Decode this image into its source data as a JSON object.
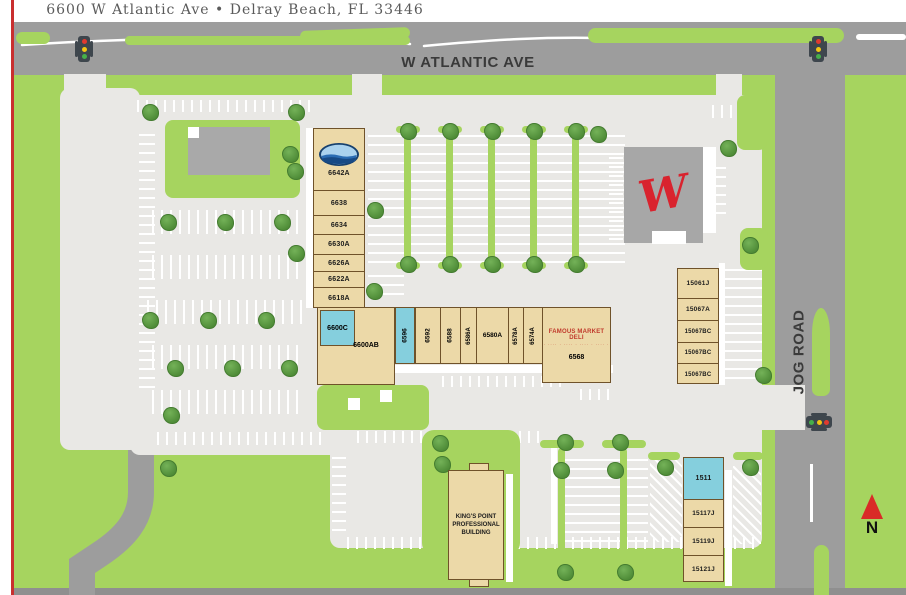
{
  "header": {
    "address": "6600 W Atlantic Ave • Delray Beach, FL 33446"
  },
  "roads": {
    "atlantic_label": "W ATLANTIC AVE",
    "jog_label": "JOG ROAD"
  },
  "compass": {
    "north_label": "N"
  },
  "colors": {
    "grass": "#a6d45f",
    "road": "#9d9d9d",
    "parking": "#e9e8e5",
    "building_tan": "#ecd9a8",
    "highlight_unit": "#85cfdd",
    "walgreens_red": "#d9232e",
    "deli_red": "#c0392b",
    "boundary_line": "#c92f2f"
  },
  "buildings": {
    "north_strip": {
      "units": [
        {
          "label": "6642A"
        },
        {
          "label": "6638"
        },
        {
          "label": "6634"
        },
        {
          "label": "6630A"
        },
        {
          "label": "6626A"
        },
        {
          "label": "6622A"
        },
        {
          "label": "6618A"
        }
      ]
    },
    "main_strip": {
      "units": [
        {
          "label": "6600C"
        },
        {
          "label": "6600AB"
        },
        {
          "label": "6596"
        },
        {
          "label": "6592"
        },
        {
          "label": "6588"
        },
        {
          "label": "6586A"
        },
        {
          "label": "6580A"
        },
        {
          "label": "6578A"
        },
        {
          "label": "6574A"
        }
      ],
      "deli": {
        "name": "FAMOUS MARKET DELI",
        "tagline": "· ···· · ···· · ···· · ···· ·",
        "unit": "6568"
      }
    },
    "walgreens": {
      "logo_letter": "W"
    },
    "east_strip": {
      "units": [
        {
          "label": "15061J"
        },
        {
          "label": "15067A"
        },
        {
          "label": "15067BC"
        },
        {
          "label": "15067BC"
        },
        {
          "label": "15067BC"
        }
      ]
    },
    "kings_point": {
      "name": "KING'S POINT PROFESSIONAL BUILDING"
    },
    "south_strip": {
      "units": [
        {
          "label": "1511"
        },
        {
          "label": "15117J"
        },
        {
          "label": "15119J"
        },
        {
          "label": "15121J"
        }
      ]
    }
  }
}
